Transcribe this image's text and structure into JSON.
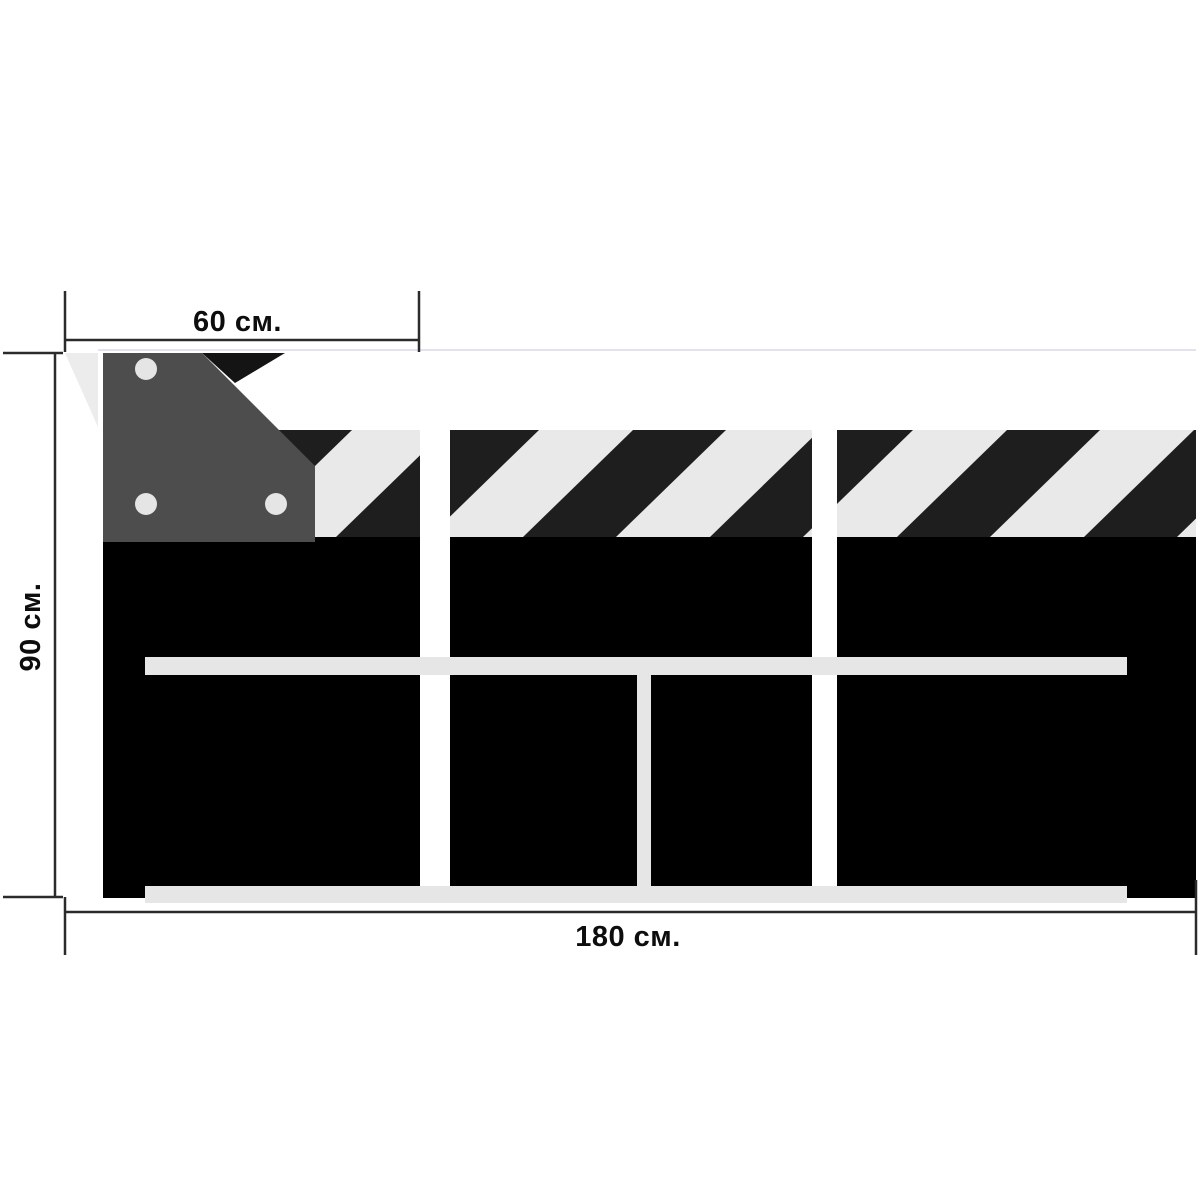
{
  "title": "Barrier panel technical drawing",
  "dimensions": {
    "top_width": "60 см.",
    "left_height": "90 см.",
    "bottom_width": "180 см."
  },
  "figure": {
    "panel_count": 3,
    "bolt_hole_count": 3,
    "rail_count": 2,
    "hazard_band": "diagonal black and light-gray stripes",
    "bracket": "dark corner plate with bolt holes on left panel"
  },
  "colors": {
    "background": "#ffffff",
    "panel_body": "#000000",
    "stripe_dark": "#1e1e1e",
    "stripe_light": "#e9e9e9",
    "rail_gray": "#e6e6e6",
    "bracket_gray": "#4d4d4d",
    "bolt_hole": "#e5e5e5",
    "wedge_light": "#ececec",
    "wedge_dark": "#141414",
    "top_hairline": "#e3e3ef",
    "dimension_line": "#2b2b2b",
    "label_text": "#0d0d0d"
  }
}
